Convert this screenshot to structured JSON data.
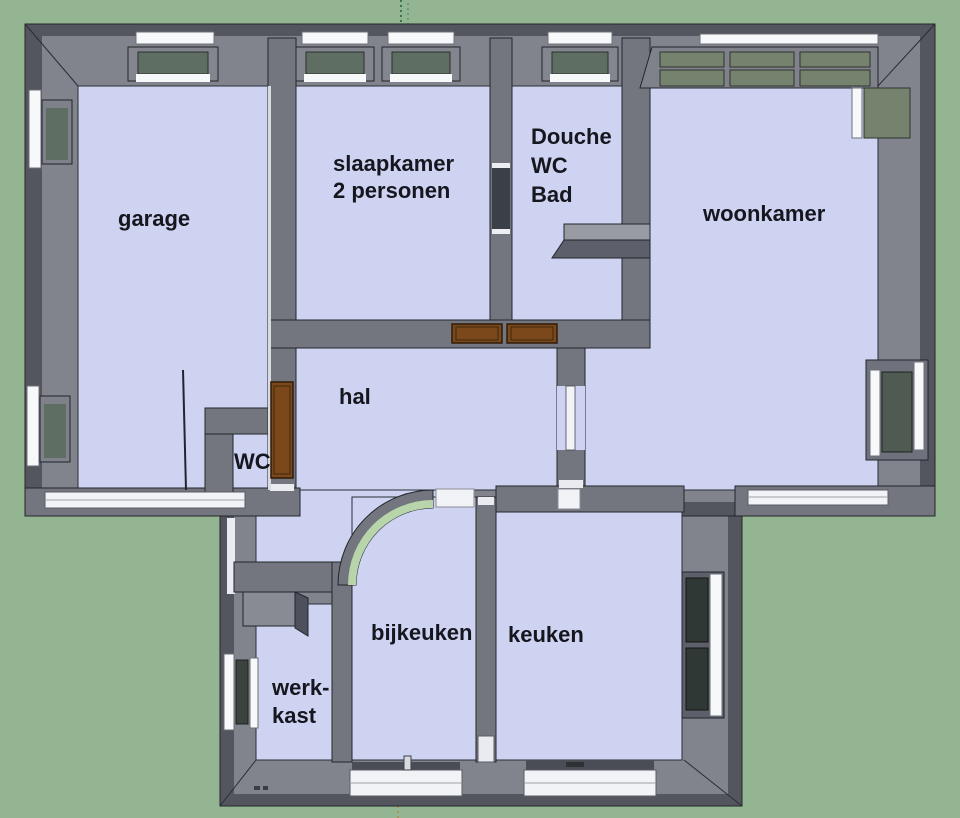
{
  "scene": {
    "type": "3d-floorplan-top-view",
    "colors": {
      "background": "#94b591",
      "floor": "#cdd3f0",
      "wall_top": "#82848d",
      "wall_side": "#53565f",
      "wall_inner": "#74767f",
      "window_frame": "#f7f8fa",
      "window_glass": "#5f6e62",
      "window_glass_band": "#75836e",
      "window_glass_dark": "#2f3835",
      "door_wood": "#7b481c",
      "curved_wall_accent": "#b8d4ab",
      "label_text": "#16161e"
    }
  },
  "rooms": {
    "garage": {
      "label": "garage"
    },
    "slaapkamer": {
      "label": "slaapkamer\n2 personen"
    },
    "badkamer": {
      "label": "Douche\nWC\nBad"
    },
    "woonkamer": {
      "label": "woonkamer"
    },
    "hal": {
      "label": "hal"
    },
    "wc": {
      "label": "WC"
    },
    "bijkeuken": {
      "label": "bijkeuken"
    },
    "keuken": {
      "label": "keuken"
    },
    "werkkast": {
      "label": "werk-\nkast"
    }
  }
}
